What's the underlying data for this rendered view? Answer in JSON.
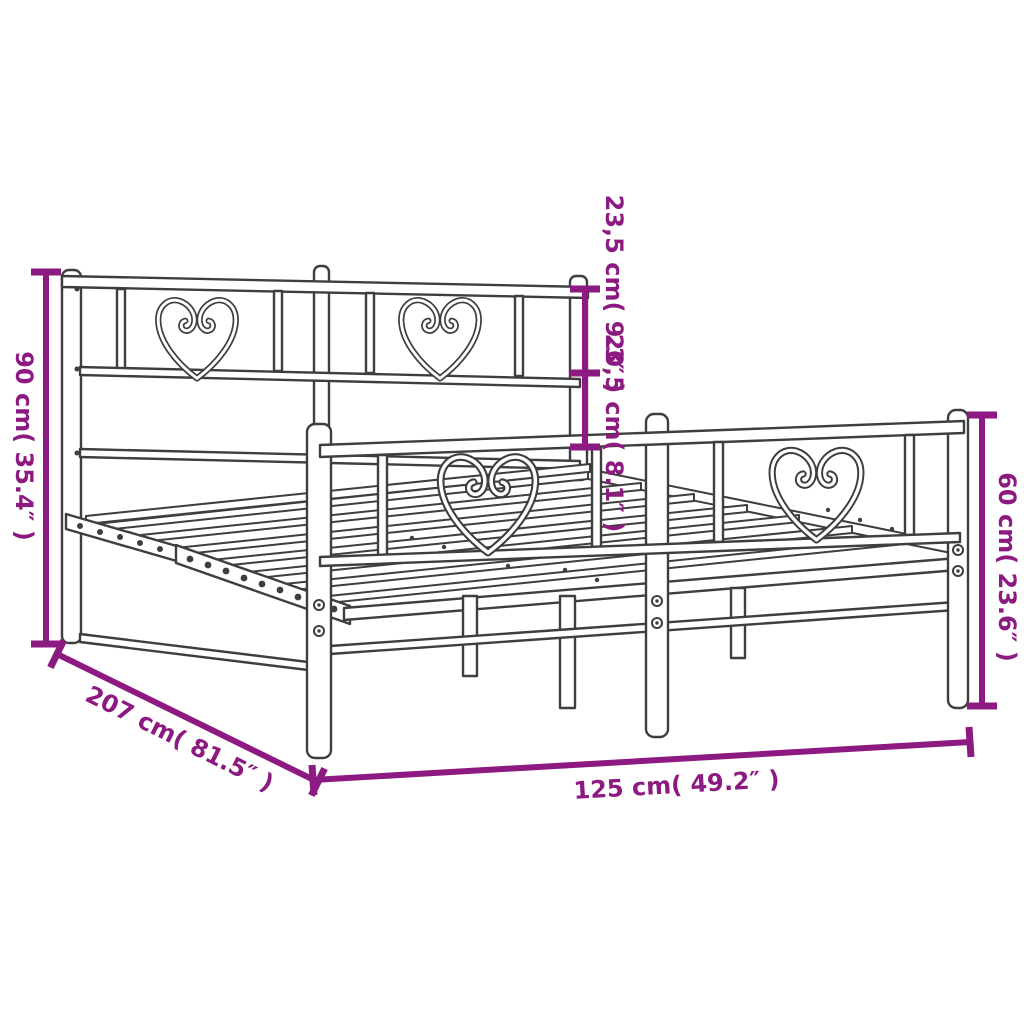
{
  "diagram": {
    "subject": "metal-bed-frame-with-heart-scroll-headboard-and-footboard",
    "colors": {
      "dimension_accent": "#8D1A80",
      "line_art": "#3E3E3E",
      "background": "#FFFFFF"
    },
    "dimensions": {
      "overall_height": "90 cm( 35.4″ )",
      "headboard_upper_section": "23,5 cm( 9.3″ )",
      "headboard_lower_section": "20,5 cm( 8.1″ )",
      "footboard_height": "60 cm( 23.6″ )",
      "bed_length": "207 cm( 81.5″ )",
      "bed_width": "125 cm( 49.2″ )"
    }
  }
}
